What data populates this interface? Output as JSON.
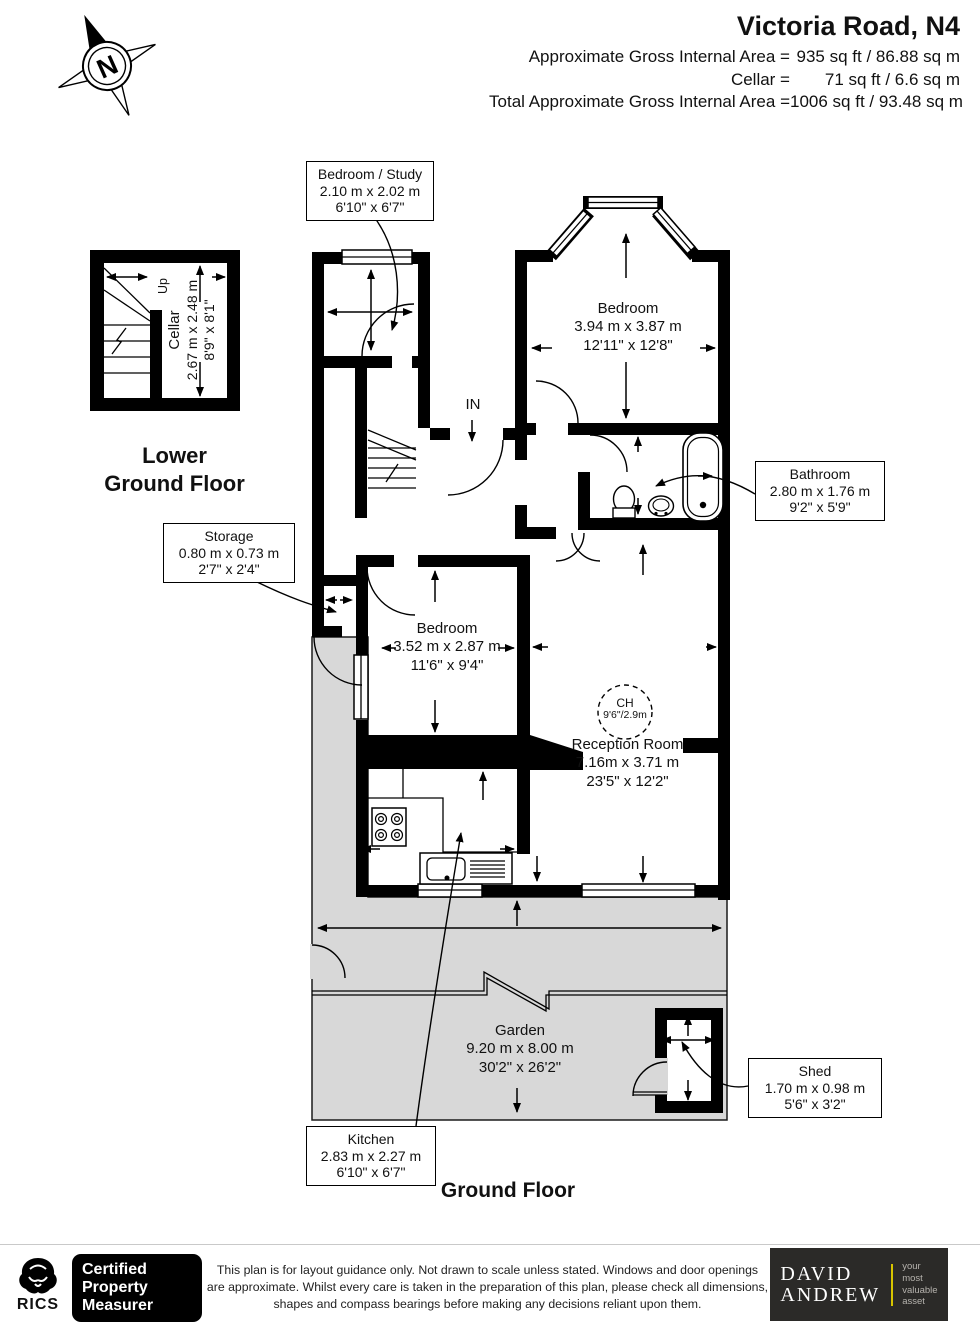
{
  "header": {
    "title": "Victoria Road, N4",
    "compass_letter": "N",
    "area_lines": [
      {
        "label": "Approximate Gross Internal Area =",
        "value": "935 sq ft / 86.88 sq m"
      },
      {
        "label": "Cellar =",
        "value": "71 sq ft / 6.6 sq m"
      },
      {
        "label": "Total Approximate Gross Internal Area =",
        "value": "1006 sq ft / 93.48 sq m"
      }
    ]
  },
  "floors": {
    "lower_ground": [
      "Lower",
      "Ground Floor"
    ],
    "ground": "Ground Floor"
  },
  "labels": {
    "cellar": {
      "name": "Cellar",
      "metric": "2.67 m x 2.48 m",
      "imperial": "8'9\" x 8'1\""
    },
    "up_label": "Up",
    "in_label": "IN",
    "bedroom_study": {
      "name": "Bedroom / Study",
      "metric": "2.10 m x 2.02 m",
      "imperial": "6'10\" x 6'7\""
    },
    "bedroom_main": {
      "name": "Bedroom",
      "metric": "3.94 m x 3.87 m",
      "imperial": "12'11\" x 12'8\""
    },
    "bathroom": {
      "name": "Bathroom",
      "metric": "2.80 m x 1.76 m",
      "imperial": "9'2\" x 5'9\""
    },
    "storage": {
      "name": "Storage",
      "metric": "0.80 m x 0.73 m",
      "imperial": "2'7\" x 2'4\""
    },
    "bedroom_second": {
      "name": "Bedroom",
      "metric": "3.52 m x 2.87 m",
      "imperial": "11'6\" x 9'4\""
    },
    "reception": {
      "name": "Reception Room",
      "metric": "7.16m x 3.71 m",
      "imperial": "23'5\" x 12'2\""
    },
    "ch": {
      "name": "CH",
      "value": "9'6\"/2.9m"
    },
    "kitchen": {
      "name": "Kitchen",
      "metric": "2.83 m x 2.27 m",
      "imperial": "6'10\" x 6'7\""
    },
    "garden": {
      "name": "Garden",
      "metric": "9.20 m x 8.00 m",
      "imperial": "30'2\" x 26'2\""
    },
    "shed": {
      "name": "Shed",
      "metric": "1.70 m x 0.98 m",
      "imperial": "5'6\" x 3'2\""
    }
  },
  "footer": {
    "rics": "RICS",
    "certification": [
      "Certified",
      "Property",
      "Measurer"
    ],
    "disclaimer": [
      "This plan is for layout guidance only. Not drawn to scale unless stated. Windows and door openings",
      "are approximate. Whilst every care is taken in the preparation of this plan, please check all dimensions,",
      "shapes and compass bearings before making any decisions reliant upon them."
    ],
    "brand": {
      "line1": "DAVID",
      "line2": "ANDREW",
      "tagline": [
        "your",
        "most",
        "valuable",
        "asset"
      ]
    }
  },
  "colors": {
    "garden": "#d8d8d8",
    "wall": "#000000",
    "brand_box": "#2b2a28",
    "brand_accent": "#d8c500"
  }
}
